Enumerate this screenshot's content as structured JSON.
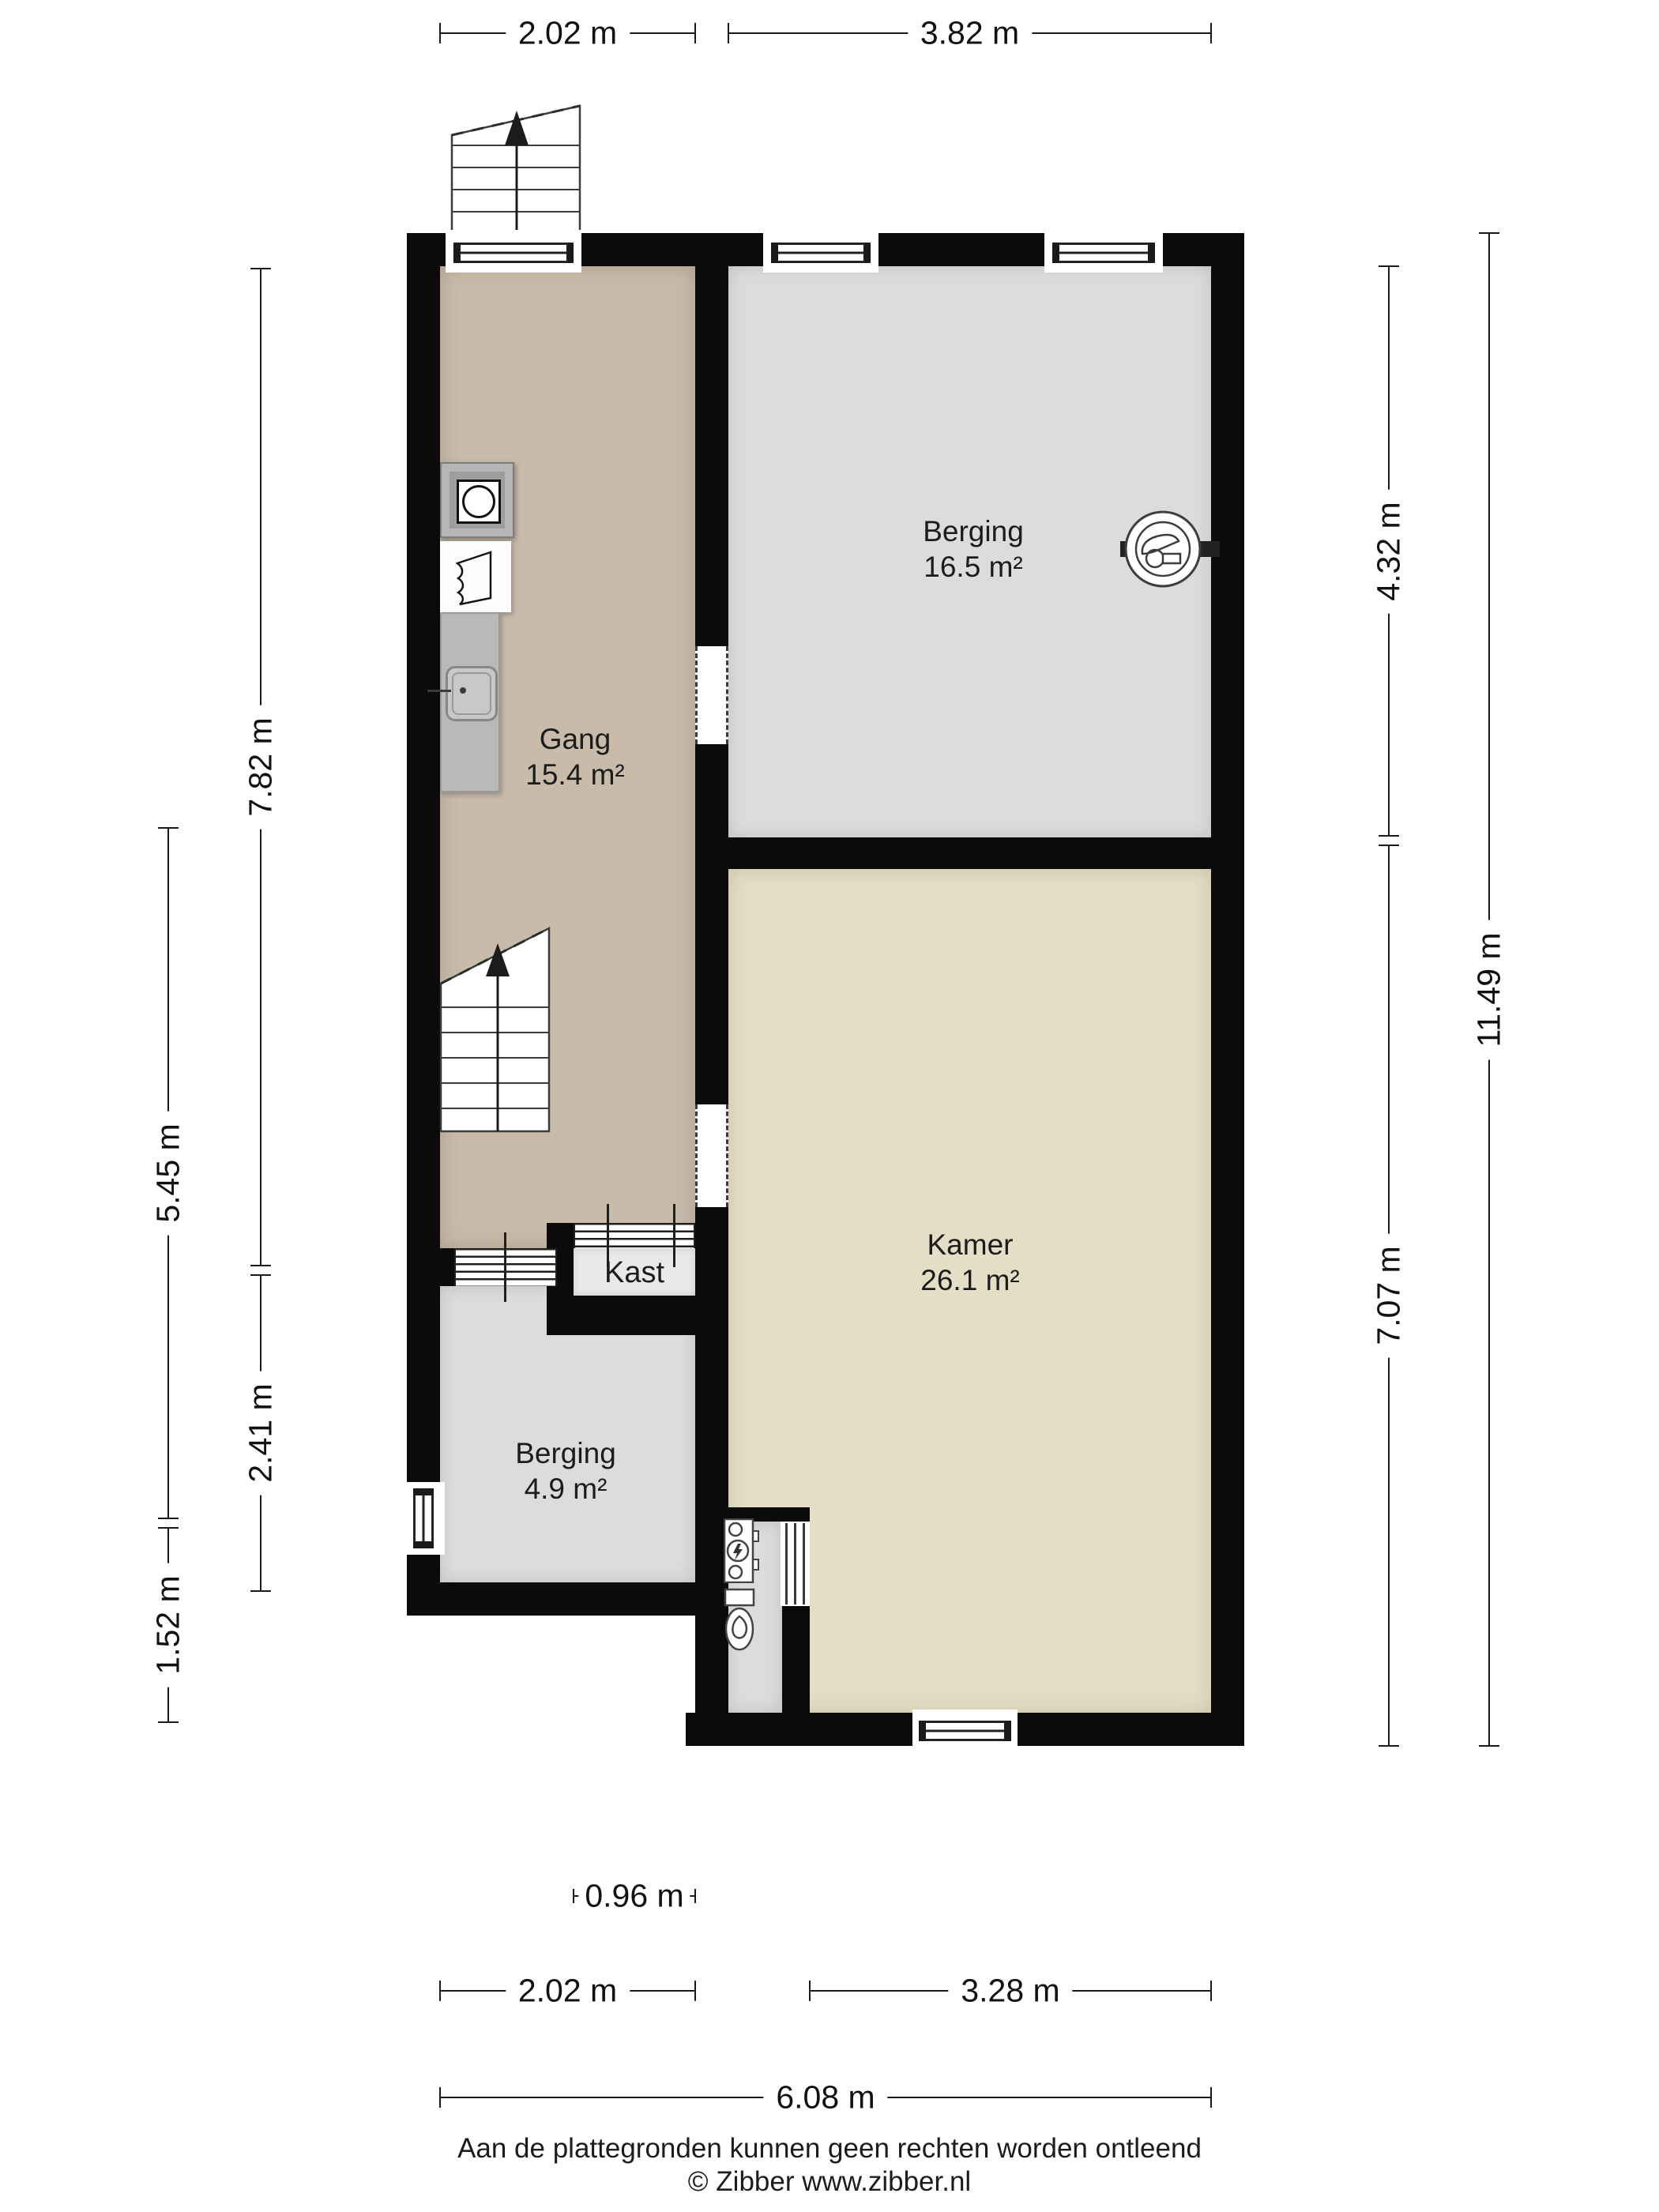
{
  "rooms": {
    "berging_boven": {
      "name": "Berging",
      "area": "16.5 m²"
    },
    "gang": {
      "name": "Gang",
      "area": "15.4 m²"
    },
    "kamer": {
      "name": "Kamer",
      "area": "26.1 m²"
    },
    "berging_beneden": {
      "name": "Berging",
      "area": "4.9 m²"
    },
    "kast": {
      "name": "Kast"
    }
  },
  "dimensions": {
    "top_gang": "2.02 m",
    "top_berging": "3.82 m",
    "left_gang": "7.82 m",
    "left_berging_klein": "2.41 m",
    "left_midden": "5.45 m",
    "left_onder": "1.52 m",
    "right_berging": "4.32 m",
    "right_kamer": "7.07 m",
    "right_totaal": "11.49 m",
    "bottom_kast": "0.96 m",
    "bottom_berging_klein": "2.02 m",
    "bottom_kamer": "3.28 m",
    "bottom_totaal": "6.08 m"
  },
  "footer": {
    "disclaimer": "Aan de plattegronden kunnen geen rechten worden ontleend",
    "copyright": "© Zibber www.zibber.nl"
  },
  "colors": {
    "wall": "#0b0b0b",
    "floor_gang": "#c9bbaa",
    "floor_berging": "#dcdcdc",
    "floor_kamer": "#e5dec6",
    "floor_kast": "#e9e9e9",
    "background": "#ffffff"
  }
}
